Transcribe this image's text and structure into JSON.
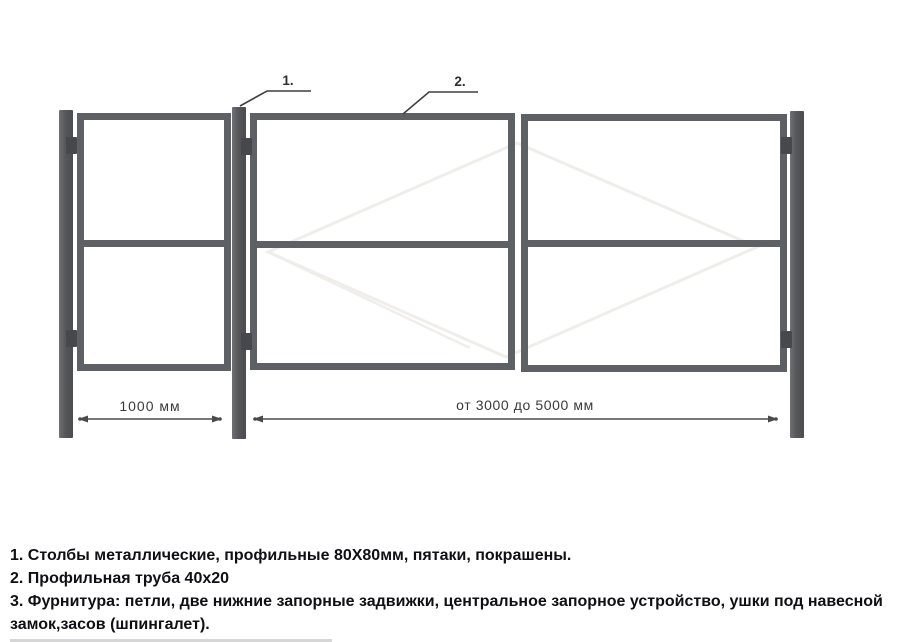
{
  "diagram": {
    "callouts": [
      {
        "label": "1."
      },
      {
        "label": "2."
      }
    ],
    "dimensions": [
      {
        "label": "1000 мм"
      },
      {
        "label": "от 3000 до 5000 мм"
      }
    ],
    "colors": {
      "tube": "#5d6064",
      "post": "#55575a",
      "hinge": "#47484c",
      "line": "#3f3f3f",
      "dim": "#4a4a4a",
      "watermark": "#efeeeb"
    }
  },
  "notes": [
    "1. Столбы металлические, профильные 80Х80мм, пятаки, покрашены.",
    "2. Профильная труба 40х20",
    "3. Фурнитура: петли, две нижние запорные задвижки, центральное запорное устройство, ушки под навесной замок,засов (шпингалет)."
  ]
}
